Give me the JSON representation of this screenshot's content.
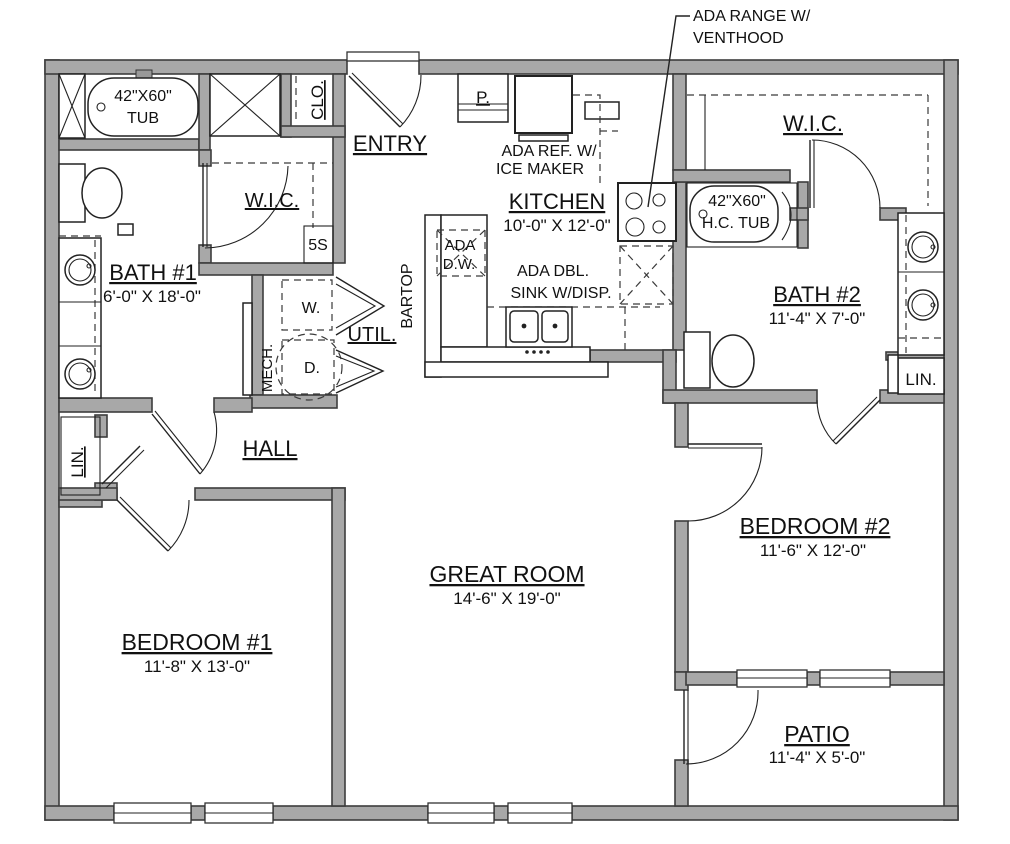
{
  "rooms": {
    "entry": {
      "name": "ENTRY"
    },
    "kitchen": {
      "name": "KITCHEN",
      "dims": "10'-0\" X 12'-0\""
    },
    "wic_left": {
      "name": "W.I.C."
    },
    "wic_right": {
      "name": "W.I.C."
    },
    "bath1": {
      "name": "BATH #1",
      "dims": "6'-0\" X 18'-0\""
    },
    "bath2": {
      "name": "BATH #2",
      "dims": "11'-4\" X 7'-0\""
    },
    "util": {
      "name": "UTIL."
    },
    "hall": {
      "name": "HALL"
    },
    "great_room": {
      "name": "GREAT ROOM",
      "dims": "14'-6\" X 19'-0\""
    },
    "bedroom1": {
      "name": "BEDROOM #1",
      "dims": "11'-8\" X 13'-0\""
    },
    "bedroom2": {
      "name": "BEDROOM #2",
      "dims": "11'-6\" X 12'-0\""
    },
    "patio": {
      "name": "PATIO",
      "dims": "11'-4\" X 5'-0\""
    },
    "closet": {
      "name": "CLO."
    },
    "lin_left": {
      "name": "LIN."
    },
    "lin_right": {
      "name": "LIN."
    },
    "pantry": {
      "name": "P."
    },
    "shelves": {
      "name": "5S"
    },
    "mech": {
      "name": "MECH."
    },
    "washer": {
      "name": "W."
    },
    "dryer": {
      "name": "D."
    },
    "bartop": {
      "name": "BARTOP"
    }
  },
  "fixtures": {
    "tub1": {
      "line1": "42\"X60\"",
      "line2": "TUB"
    },
    "tub2": {
      "line1": "42\"X60\"",
      "line2": "H.C. TUB"
    },
    "range_callout": {
      "line1": "ADA RANGE W/",
      "line2": "VENTHOOD"
    },
    "fridge": {
      "line1": "ADA REF. W/",
      "line2": "ICE MAKER"
    },
    "dishwasher": {
      "line1": "ADA",
      "line2": "D.W."
    },
    "sink": {
      "line1": "ADA DBL.",
      "line2": "SINK W/DISP."
    }
  },
  "colors": {
    "wall_fill": "#a8a8a8",
    "wall_stroke": "#3d3d3d",
    "line": "#222222",
    "background": "#ffffff"
  }
}
